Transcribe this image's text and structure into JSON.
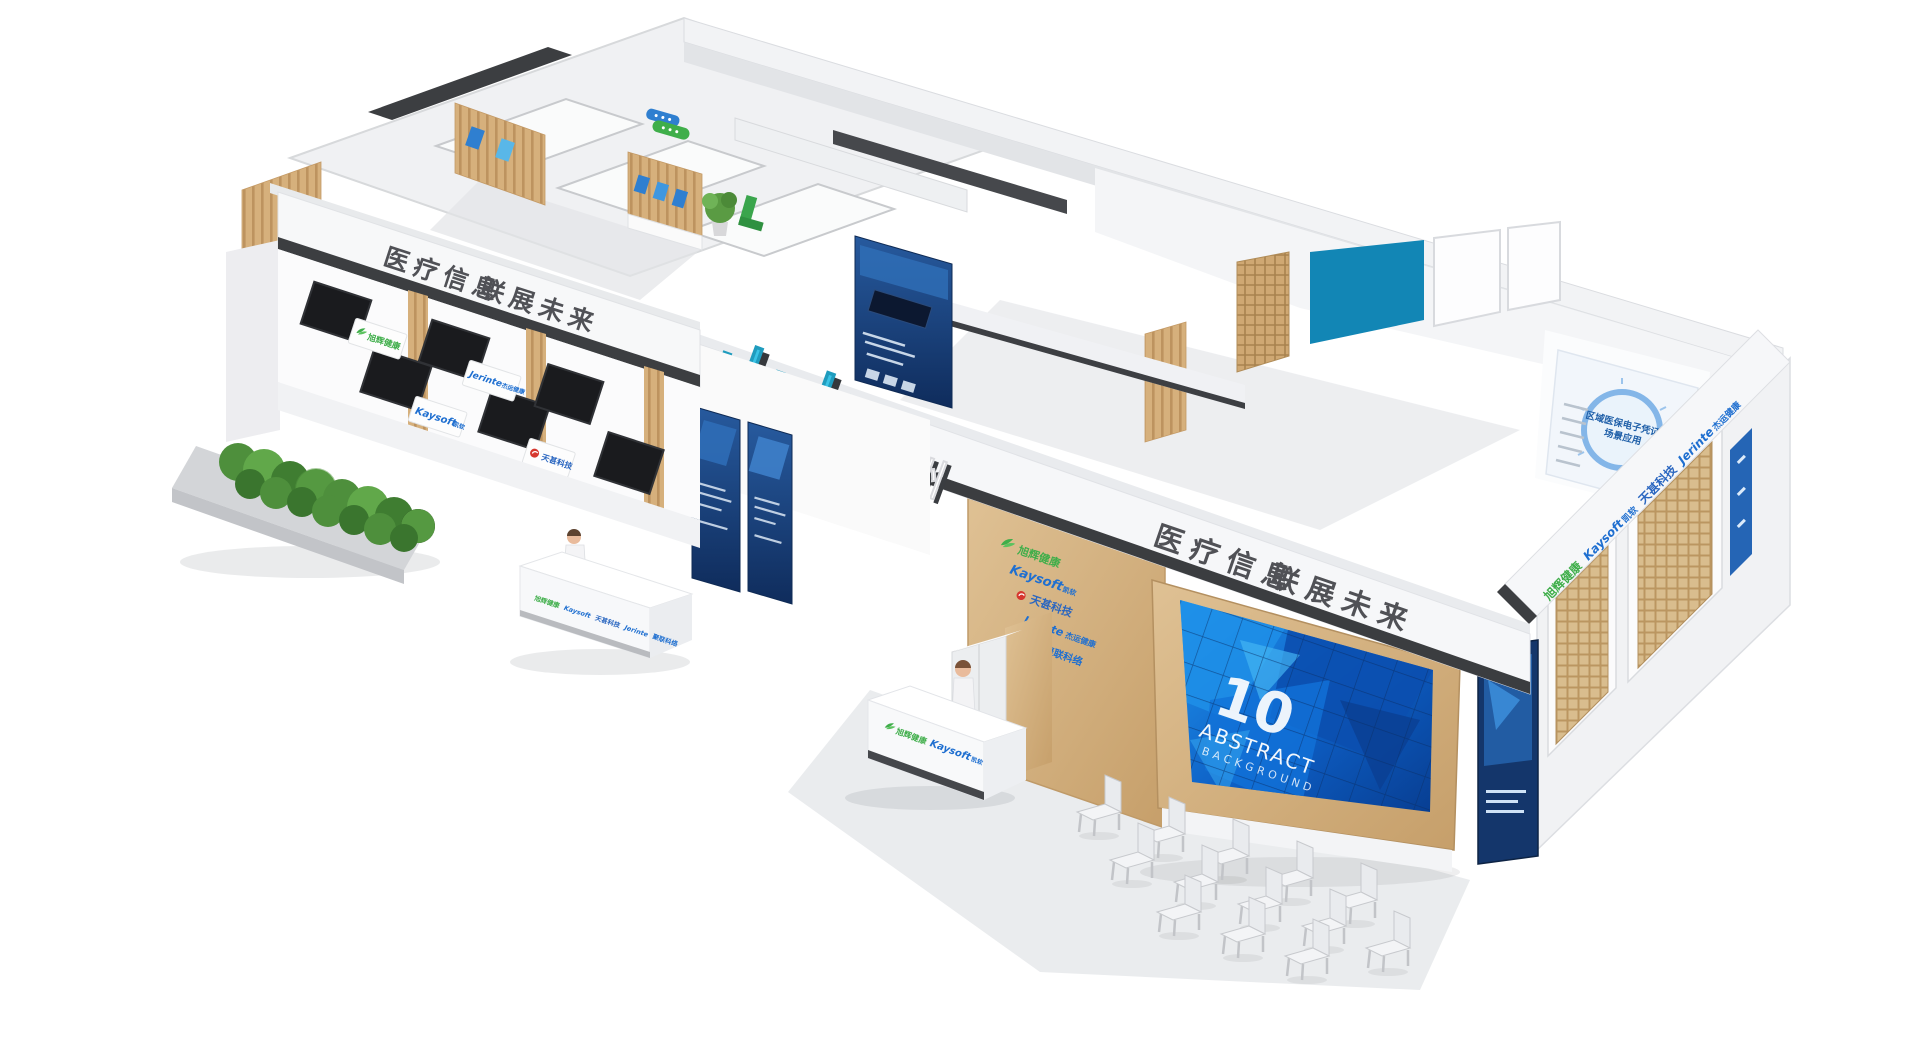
{
  "scene": {
    "description": "Isometric 3D rendering of a two-hall exhibition booth for medical information companies",
    "brand": {
      "main": "山水",
      "sub": "温州"
    }
  },
  "signage": {
    "fascia_left_1": "医疗信息",
    "fascia_left_2": "联展未来",
    "fascia_right_1": "医疗信息",
    "fascia_right_2": "联展未来"
  },
  "video_wall": {
    "number": "10",
    "title": "ABSTRACT",
    "subtitle": "BACKGROUND"
  },
  "companies": {
    "c1": {
      "zh": "旭辉健康"
    },
    "c2": {
      "en": "Kaysoft",
      "zh": "凯软"
    },
    "c3": {
      "zh": "天甚科技"
    },
    "c4": {
      "en": "Jerinte",
      "zh": "杰运健康"
    },
    "c5": {
      "zh": "聚联科络"
    }
  },
  "poster": {
    "title_line1": "区域医保电子凭证",
    "title_line2": "场景应用"
  },
  "colors": {
    "brand_cyan": "#3ac3e6",
    "company_green": "#3fae4a",
    "company_blue": "#1f6fd0",
    "company_red": "#d6372e",
    "teal_panel": "#1286b5",
    "screen_blue": "#0f63c8",
    "wood": "#d2ab77",
    "dark_strip": "#3b3d40"
  }
}
